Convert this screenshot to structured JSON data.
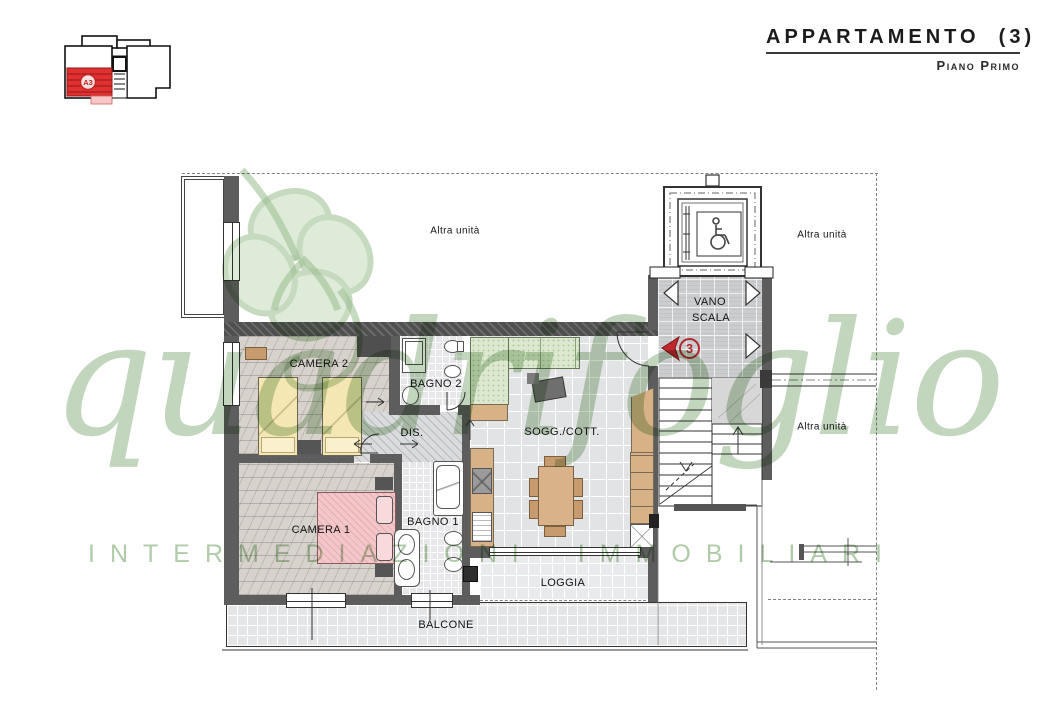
{
  "header": {
    "title": "APPARTAMENTO  (3)",
    "subtitle": "Piano Primo"
  },
  "key_plan": {
    "unit_label": "A3"
  },
  "watermark": {
    "script": "quadrifoglio",
    "caption": "INTERMEDIAZIONI IMMOBILIARI"
  },
  "plan": {
    "unit_marker": "3",
    "labels": {
      "camera2": "CAMERA 2",
      "bagno2": "BAGNO 2",
      "dis": "DIS.",
      "camera1": "CAMERA 1",
      "bagno1": "BAGNO 1",
      "soggiorno": "SOGG./COTT.",
      "vano_line1": "VANO",
      "vano_line2": "SCALA",
      "loggia": "LOGGIA",
      "balcone": "BALCONE",
      "neighbor_top": "Altra unità",
      "neighbor_right": "Altra unità",
      "neighbor_bottom_right": "Altra unità"
    }
  },
  "colors": {
    "highlight_red": "#d92b2b",
    "marker_red": "#b3282d",
    "watermark_green": "#9cbe92",
    "bed_yellow": "#f5e7b3",
    "bed_pink": "#f3c6ca",
    "sofa_green": "#dce9cf",
    "wood_tan": "#d7b286",
    "wall_gray": "#5d5d5d"
  }
}
